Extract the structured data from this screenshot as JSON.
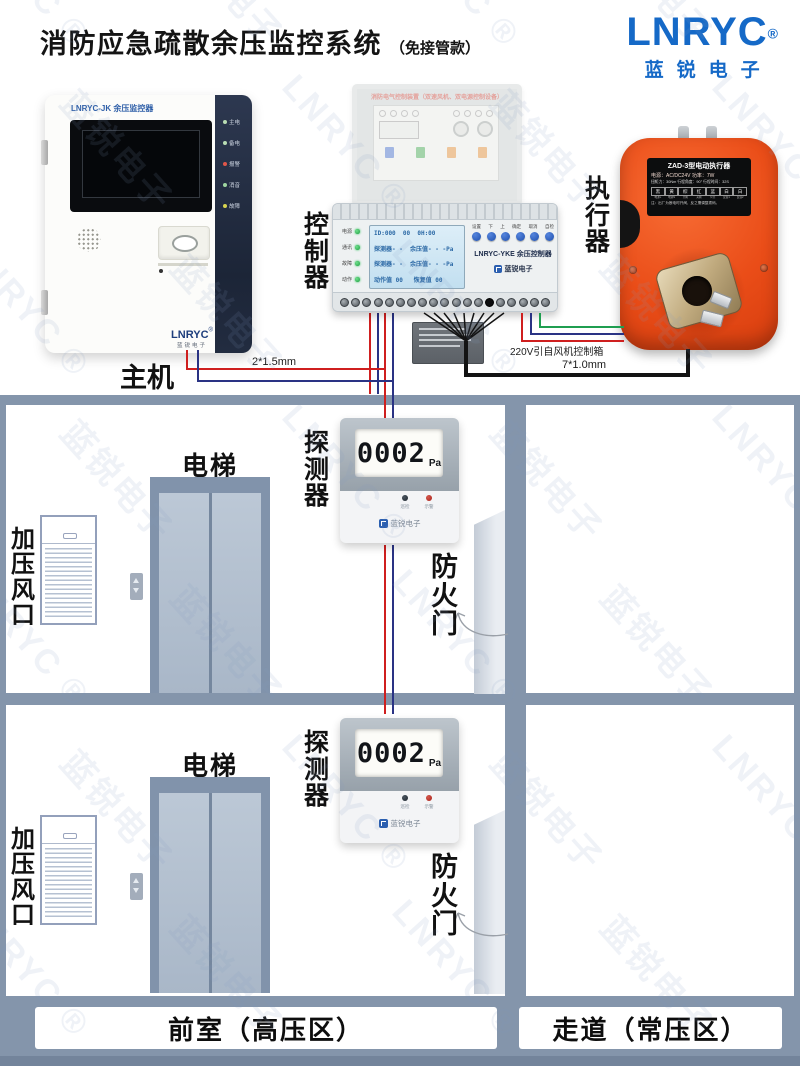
{
  "header": {
    "title": "消防应急疏散余压监控系统",
    "subtitle": "（免接管款）",
    "brand_logo": "LNRYC",
    "brand_reg": "®",
    "brand_cn": "蓝锐电子"
  },
  "watermark": {
    "brand": "LNRYC ®",
    "brand_cn": "蓝锐电子"
  },
  "colors": {
    "brand_blue": "#1569c7",
    "actuator_orange": "#ea4d18",
    "wall_gray": "#8495ab",
    "wire_red": "#cf1f1f",
    "wire_navy": "#2a3384",
    "wire_green": "#1f9e50",
    "led_red": "#e0564a",
    "led_green": "#2fbf59"
  },
  "main_unit": {
    "label": "主机",
    "model_title": "LNRYC-JK 余压监控器",
    "indicators": [
      {
        "label": "主电"
      },
      {
        "label": "备电"
      },
      {
        "label": "报警"
      },
      {
        "label": "消音"
      },
      {
        "label": "故障"
      }
    ],
    "logo": "LNRYC",
    "logo_reg": "®",
    "logo_sub": "蓝锐电子"
  },
  "ghost_panel": {
    "title": "消防电气控制装置（双速风机、双电源控制设备）"
  },
  "controller": {
    "label": "控制器",
    "model": "LNRYC-YKE 余压控制器",
    "brand": "蓝锐电子",
    "leds": [
      "电源",
      "通讯",
      "故障",
      "动作"
    ],
    "buttons": [
      "设置",
      "下",
      "上",
      "确定",
      "取消",
      "自检"
    ],
    "lcd_lines": [
      "ID:000  00  0H:00",
      "探测器- -  余压值- - -Pa",
      "探测器- -  余压值- - -Pa",
      "动作值 00   恢复值 00"
    ]
  },
  "actuator": {
    "label": "执行器",
    "plate_title": "ZAD-3型电动执行器",
    "plate_line1": "电源：AC/DC24V   功率：7W",
    "plate_line2": "扭矩力：30Nm 行程角度：90° 行程时间：32S",
    "wire_cells": [
      "黑",
      "黄",
      "棕",
      "红",
      "蓝",
      "白",
      "白"
    ],
    "wire_subs": [
      "电源L",
      "电源N",
      "开阀",
      "关阀",
      "公共",
      "反馈1",
      "反馈2"
    ],
    "plate_note": "注：出厂为断电时开阀，反之需调整拨码。"
  },
  "wiring": {
    "label_left": "2*1.5mm",
    "label_220v": "220V引自风机控制箱",
    "label_right": "7*1.0mm"
  },
  "building": {
    "floors": [
      {
        "elevator": "电梯",
        "vent": "加压风口",
        "detector": "探测器",
        "value": "0002",
        "unit": "Pa",
        "door": "防火门"
      },
      {
        "elevator": "电梯",
        "vent": "加压风口",
        "detector": "探测器",
        "value": "0002",
        "unit": "Pa",
        "door": "防火门"
      }
    ],
    "detector_leds": [
      "巡检",
      "示警"
    ],
    "detector_brand": "蓝锐电子",
    "bottom_left": "前室（高压区）",
    "bottom_right": "走道（常压区）"
  }
}
